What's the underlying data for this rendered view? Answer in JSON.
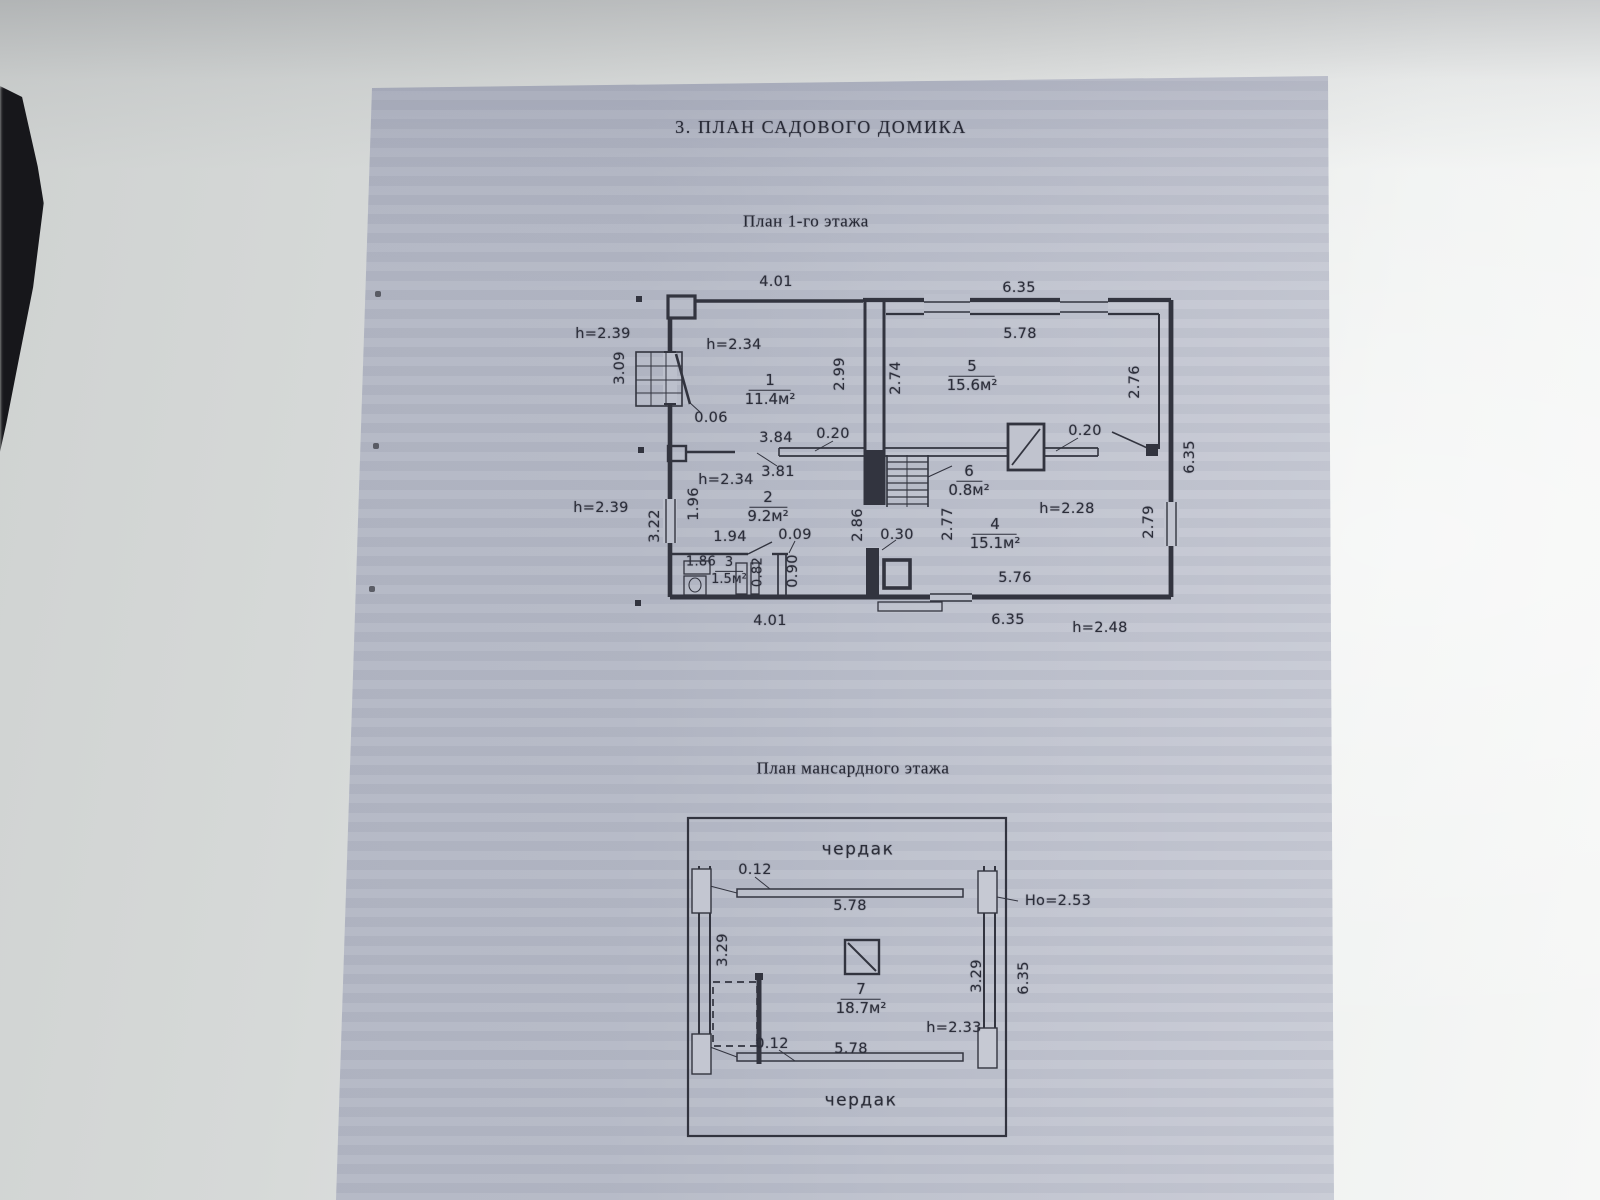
{
  "page": {
    "title": "3. ПЛАН САДОВОГО ДОМИКА"
  },
  "colors": {
    "paper": "#bcc0cc",
    "ink": "#32343f"
  },
  "floor1": {
    "subtitle": "План  1-го этажа",
    "rooms": {
      "r1": {
        "num": "1",
        "area": "11.4м²"
      },
      "r2": {
        "num": "2",
        "area": "9.2м²"
      },
      "r3": {
        "num": "3",
        "area": "1.5м²"
      },
      "r4": {
        "num": "4",
        "area": "15.1м²"
      },
      "r5": {
        "num": "5",
        "area": "15.6м²"
      },
      "r6": {
        "num": "6",
        "area": "0.8м²"
      }
    },
    "dims": {
      "d401_top": "4.01",
      "d635_top": "6.35",
      "h239_upper": "h=2.39",
      "h234_upper": "h=2.34",
      "d309": "3.09",
      "d299": "2.99",
      "d274": "2.74",
      "d578": "5.78",
      "d276": "2.76",
      "d006": "0.06",
      "d384": "3.84",
      "d020_left": "0.20",
      "d020_right": "0.20",
      "d635_right": "6.35",
      "d381": "3.81",
      "h234_lower": "h=2.34",
      "d196": "1.96",
      "d322": "3.22",
      "h239_lower": "h=2.39",
      "d286": "2.86",
      "d030": "0.30",
      "d277": "2.77",
      "h228": "h=2.28",
      "d279": "2.79",
      "d194": "1.94",
      "d009": "0.09",
      "d186": "1.86",
      "d082": "0.82",
      "d090": "0.90",
      "d576": "5.76",
      "d401_bottom": "4.01",
      "d635_bottom": "6.35",
      "h248": "h=2.48"
    }
  },
  "mansard": {
    "subtitle": "План  мансардного этажа",
    "attic_top": "чердак",
    "attic_bottom": "чердак",
    "rooms": {
      "r7": {
        "num": "7",
        "area": "18.7м²"
      }
    },
    "dims": {
      "d012_top": "0.12",
      "d578_top": "5.78",
      "ho253": "Но=2.53",
      "d329_left": "3.29",
      "d329_right": "3.29",
      "d635": "6.35",
      "h233": "h=2.33",
      "d012_bottom": "0.12",
      "d578_bottom": "5.78"
    }
  }
}
